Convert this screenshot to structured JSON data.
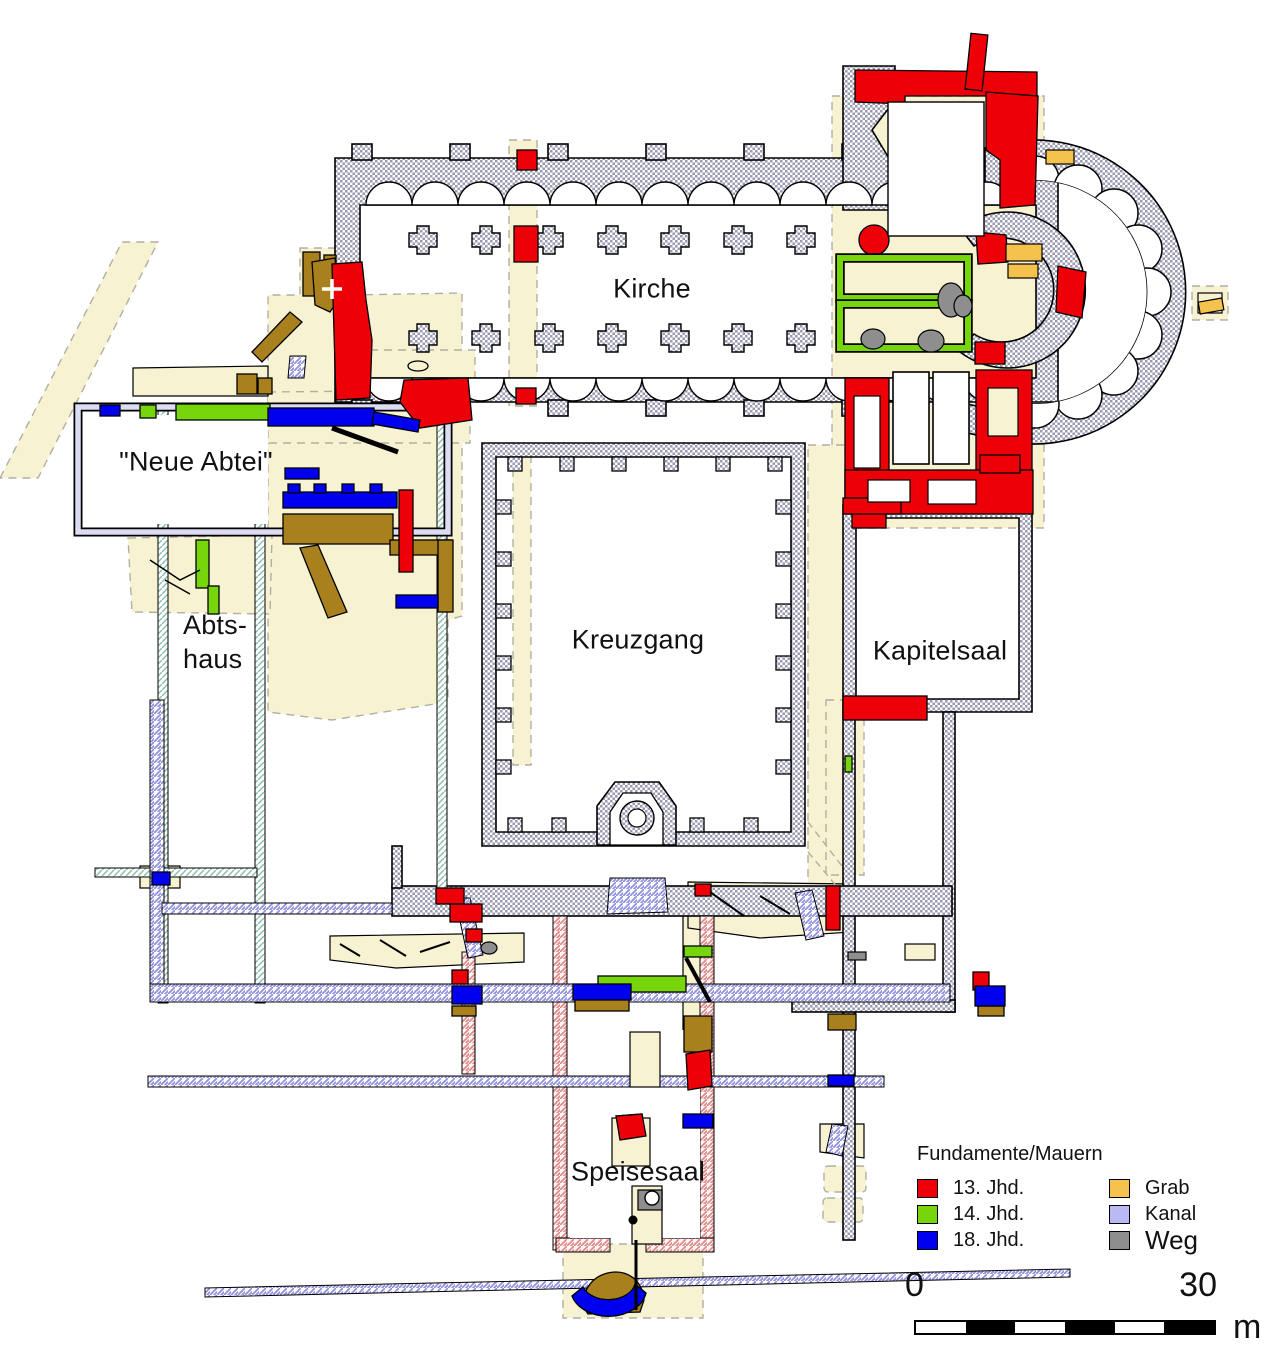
{
  "plan": {
    "labels": {
      "kirche": "Kirche",
      "neue_abtei": "\"Neue Abtei\"",
      "abtshaus_line1": "Abts-",
      "abtshaus_line2": "haus",
      "kreuzgang": "Kreuzgang",
      "kapitelsaal": "Kapitelsaal",
      "speisesaal": "Speisesaal"
    }
  },
  "legend": {
    "title": "Fundamente/Mauern",
    "columns": [
      {
        "items": [
          {
            "label": "13. Jhd.",
            "color": "#ee0008"
          },
          {
            "label": "14. Jhd.",
            "color": "#76d60b"
          },
          {
            "label": "18. Jhd.",
            "color": "#0000ee"
          }
        ]
      },
      {
        "items": [
          {
            "label": "Grab",
            "color": "#f5c34d"
          },
          {
            "label": "Kanal",
            "color": "#b9b9f4"
          },
          {
            "label": "Weg",
            "color": "#8e8e8e"
          }
        ]
      }
    ]
  },
  "scalebar": {
    "min": "0",
    "max": "30",
    "unit": "m"
  },
  "colors": {
    "wall_13th_century_red": "#ee0008",
    "wall_14th_century_green": "#76d60b",
    "wall_18th_century_blue": "#0000ee",
    "grave_orange": "#f5c34d",
    "canal_lavender": "#b9b9f4",
    "path_gray": "#8e8e8e",
    "masonry_brown": "#a8801e",
    "excavation_cream": "#f7f2d2",
    "wall_hatch_gray": "#9a9ab2",
    "wall_hatch_pink": "#e08888"
  }
}
